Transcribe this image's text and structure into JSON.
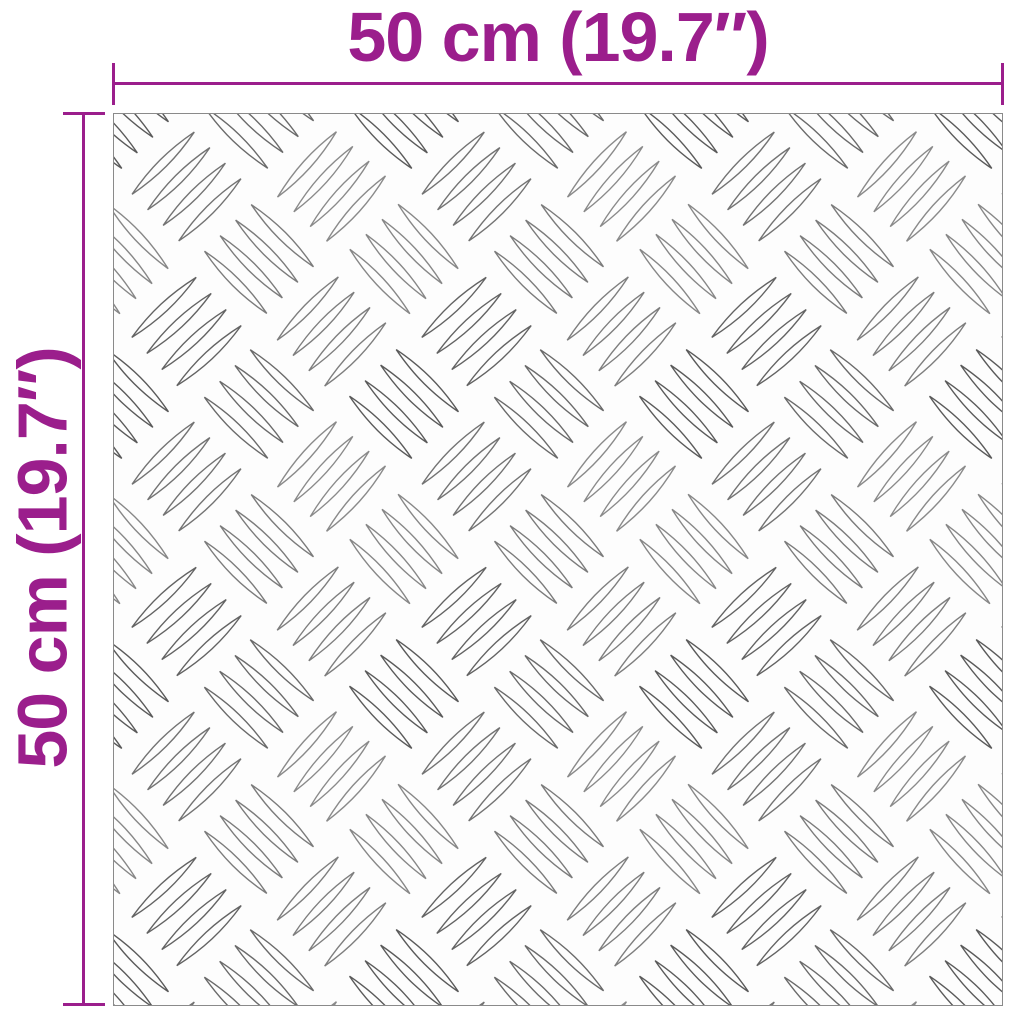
{
  "colors": {
    "accent": "#9B1E8C",
    "plate_border": "#8A8A8A",
    "rib_stroke": "#5A5A5A",
    "background": "#FFFFFF"
  },
  "dimensions": {
    "width": {
      "label": "50 cm (19.7″)"
    },
    "height": {
      "label": "50 cm (19.7″)"
    }
  },
  "plate": {
    "texture": "aluminium-checker-plate"
  }
}
